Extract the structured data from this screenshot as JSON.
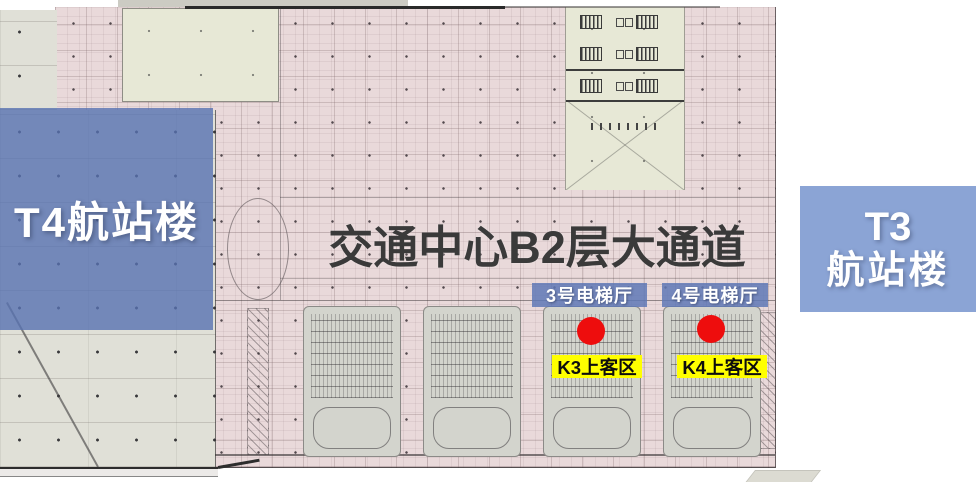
{
  "title": {
    "text": "交通中心B2层大通道"
  },
  "terminals": {
    "t4": {
      "label": "T4航站楼"
    },
    "t3": {
      "line1": "T3",
      "line2": "航站楼"
    }
  },
  "elevator_halls": [
    {
      "label": "3号电梯厅"
    },
    {
      "label": "4号电梯厅"
    }
  ],
  "pickup_zones": [
    {
      "label": "K3上客区"
    },
    {
      "label": "K4上客区"
    }
  ],
  "icons": {
    "k3_marker": "red-dot",
    "k4_marker": "red-dot"
  },
  "colors": {
    "terminal_overlay_blue": "#5872b2",
    "t3_box_blue": "#8ba4d5",
    "elevator_badge_blue": "#5f78b6",
    "pickup_badge_yellow": "#ffff00",
    "marker_red": "#ee0d0d",
    "plan_pink": "#e9d9da",
    "plan_green": "#e7e8d6",
    "parking_gray": "#e0e0d7",
    "title_text": "#3a3a3a"
  }
}
